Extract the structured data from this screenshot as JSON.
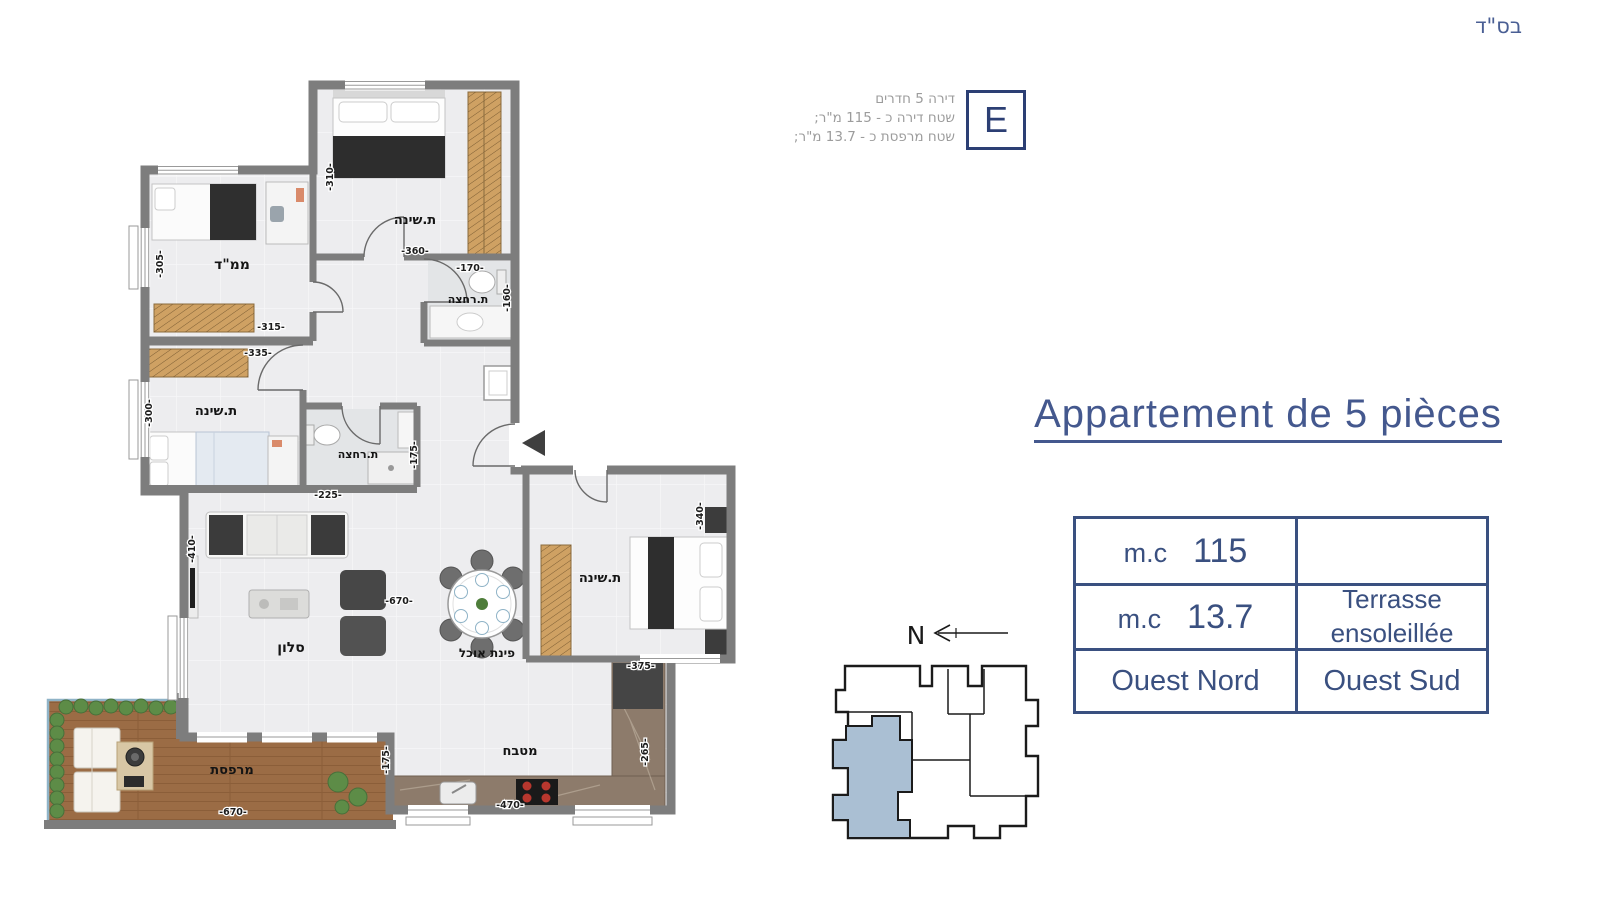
{
  "page": {
    "blessing": "בס\"ד"
  },
  "header": {
    "unit_letter": "E",
    "info_lines": [
      "דירה 5 חדרים",
      "שטח דירה כ - 115 מ\"ר;",
      "שטח מרפסת כ - 13.7 מ\"ר;"
    ]
  },
  "title": "Appartement de 5 pièces",
  "spec_table": {
    "r1c1_label": "m.c",
    "r1c1_value": "115",
    "r1c2": "",
    "r2c1_label": "m.c",
    "r2c1_value": "13.7",
    "r2c2_line1": "Terrasse",
    "r2c2_line2": "ensoleillée",
    "r3c1": "Ouest Nord",
    "r3c2": "Ouest Sud"
  },
  "plan": {
    "compass": "N",
    "labels": [
      {
        "text": "ת.שינה"
      },
      {
        "text": "ת.רחצה"
      },
      {
        "text": "ממ\"ד"
      },
      {
        "text": "ת.שינה"
      },
      {
        "text": "ת.רחצה"
      },
      {
        "text": "ת.שינה"
      },
      {
        "text": "סלון"
      },
      {
        "text": "פינת אוכל"
      },
      {
        "text": "מטבח"
      },
      {
        "text": "מרפסת"
      }
    ],
    "dims": [
      {
        "text": "-310-"
      },
      {
        "text": "-360-"
      },
      {
        "text": "-170-"
      },
      {
        "text": "-160-"
      },
      {
        "text": "-305-"
      },
      {
        "text": "-315-"
      },
      {
        "text": "-335-"
      },
      {
        "text": "-300-"
      },
      {
        "text": "-225-"
      },
      {
        "text": "-175-"
      },
      {
        "text": "-410-"
      },
      {
        "text": "-670-"
      },
      {
        "text": "-340-"
      },
      {
        "text": "-375-"
      },
      {
        "text": "-265-"
      },
      {
        "text": "-470-"
      },
      {
        "text": "-670-"
      },
      {
        "text": "-175-"
      }
    ]
  },
  "colors": {
    "accent_blue": "#44588e",
    "table_blue": "#3a5080",
    "unit_box_blue": "#2c3f74",
    "info_gray": "#9c9c9c",
    "wall_gray": "#7d7d7d",
    "wood": "#cfa163",
    "deck": "#9b6c45",
    "counter": "#8d7b6b",
    "keyplan_unit_fill": "#aabfd3"
  }
}
